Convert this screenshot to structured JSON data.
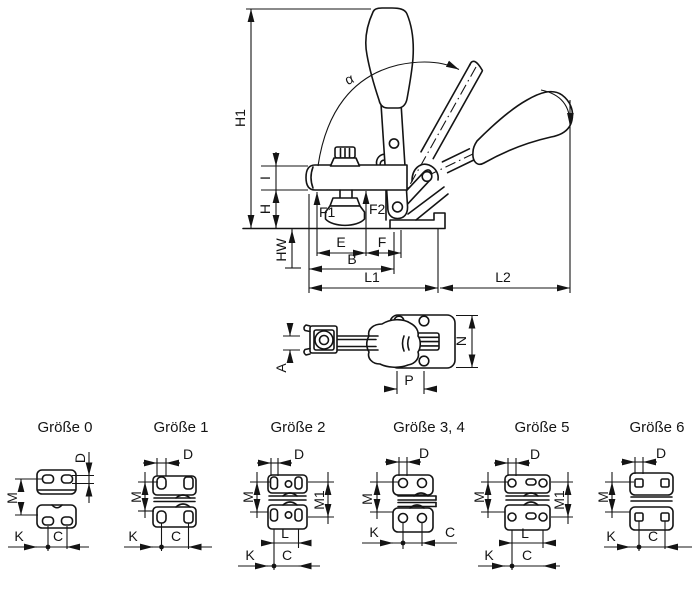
{
  "drawing": {
    "background": "#ffffff",
    "line_color": "#141414",
    "main_view": {
      "dim_labels": {
        "h1": "H1",
        "i": "I",
        "h": "H",
        "hw": "HW",
        "f1": "F1",
        "f2": "F2",
        "e": "E",
        "f": "F",
        "b": "B",
        "l1": "L1",
        "l2": "L2",
        "alpha": "α"
      }
    },
    "top_view": {
      "dim_labels": {
        "a": "A",
        "n": "N",
        "p": "P"
      }
    },
    "size_variants": [
      {
        "title": "Größe 0",
        "dims": {
          "d": "D",
          "m": "M",
          "k": "K",
          "c": "C"
        }
      },
      {
        "title": "Größe 1",
        "dims": {
          "d": "D",
          "m": "M",
          "k": "K",
          "c": "C"
        }
      },
      {
        "title": "Größe 2",
        "dims": {
          "d": "D",
          "m": "M",
          "m1": "M1",
          "l": "L",
          "k": "K",
          "c": "C"
        }
      },
      {
        "title": "Größe 3, 4",
        "dims": {
          "d": "D",
          "m": "M",
          "k": "K",
          "c": "C"
        }
      },
      {
        "title": "Größe 5",
        "dims": {
          "d": "D",
          "m": "M",
          "m1": "M1",
          "l": "L",
          "k": "K",
          "c": "C"
        }
      },
      {
        "title": "Größe 6",
        "dims": {
          "d": "D",
          "m": "M",
          "k": "K",
          "c": "C"
        }
      }
    ]
  }
}
